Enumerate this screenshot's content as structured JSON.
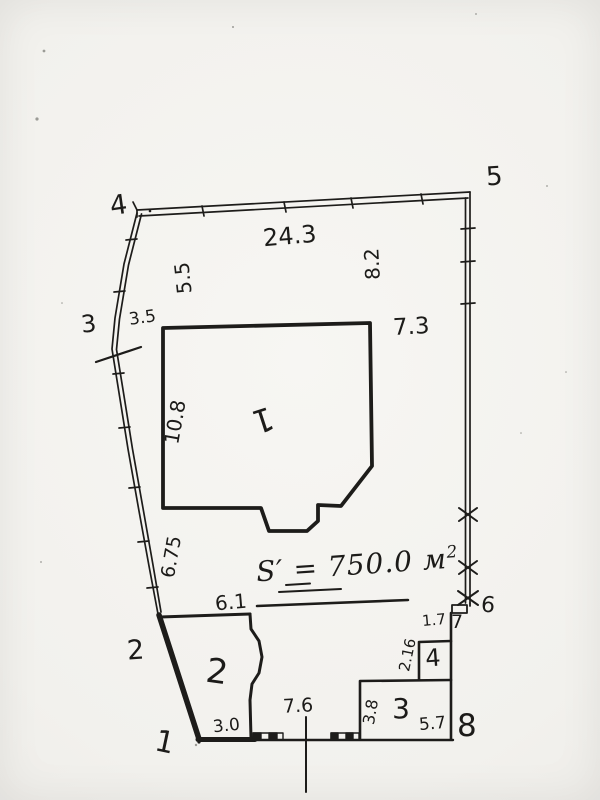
{
  "document": {
    "type": "hand-drawn land plot survey sketch",
    "ink_color": "#1d1c1a",
    "paper_color": "#f2f1ed"
  },
  "area": {
    "symbol": "S",
    "prime": "′",
    "equals_value": "= 750.0",
    "unit": "м",
    "superscript": "2"
  },
  "boundary_points": [
    {
      "id": "point-1",
      "label": "1"
    },
    {
      "id": "point-2",
      "label": "2"
    },
    {
      "id": "point-3",
      "label": "3"
    },
    {
      "id": "point-4",
      "label": "4"
    },
    {
      "id": "point-5",
      "label": "5"
    },
    {
      "id": "point-6",
      "label": "6"
    },
    {
      "id": "point-7",
      "label": "7"
    },
    {
      "id": "point-8",
      "label": "8"
    }
  ],
  "buildings": [
    {
      "id": "building-1",
      "label": "1"
    },
    {
      "id": "building-2",
      "label": "2"
    },
    {
      "id": "building-3",
      "label": "3"
    },
    {
      "id": "building-4",
      "label": "4"
    }
  ],
  "dimensions": {
    "top_side": "24.3",
    "left_upper": "5.5",
    "right_upper": "8.2",
    "near_point3": "3.5",
    "building1_right": "7.3",
    "building1_left": "10.8",
    "left_lower": "6.75",
    "building2_top": "6.1",
    "bottom_left": "3.0",
    "road_width": "7.6",
    "building3_left": "3.8",
    "building3_bottom": "5.7",
    "building4_left": "2.16",
    "building4_top": "1.7"
  }
}
